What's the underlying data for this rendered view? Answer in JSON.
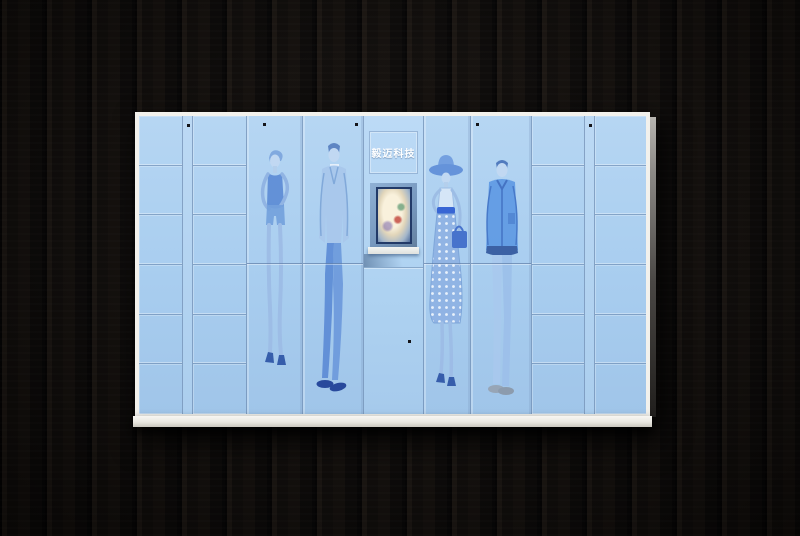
{
  "scene": {
    "description": "Product photo of a light-blue smart parcel locker cabinet standing against a dark wood plank wall",
    "background_color": "#0d0a08"
  },
  "cabinet": {
    "brand": {
      "label": "毅迈科技"
    },
    "colors": {
      "body_blue": "#a8cdef",
      "seam_blue": "#6886ac",
      "frame_white": "#f2f1ec",
      "base_white": "#e9e7e0",
      "screen_bezel": "#223a68"
    },
    "console": {
      "screen": "kiosk-display-showing-photo",
      "keyboard_tray": "pull-out-keyboard-tray"
    },
    "columns": [
      {
        "type": "small-lockers",
        "rows": 6
      },
      {
        "type": "divider-stile"
      },
      {
        "type": "small-lockers",
        "rows": 6
      },
      {
        "type": "tall-door",
        "artwork": "woman-tank-top-fashion-sketch"
      },
      {
        "type": "tall-door",
        "artwork": "man-suit-tie-fashion-sketch"
      },
      {
        "type": "console",
        "parts": [
          "brand-plate",
          "screen",
          "keyboard-tray",
          "lower-door"
        ]
      },
      {
        "type": "tall-door",
        "artwork": "woman-hat-polka-skirt-fashion-sketch"
      },
      {
        "type": "tall-door",
        "artwork": "man-jacket-jeans-fashion-sketch"
      },
      {
        "type": "small-lockers",
        "rows": 6
      },
      {
        "type": "divider-stile"
      },
      {
        "type": "small-lockers",
        "rows": 6
      }
    ]
  }
}
